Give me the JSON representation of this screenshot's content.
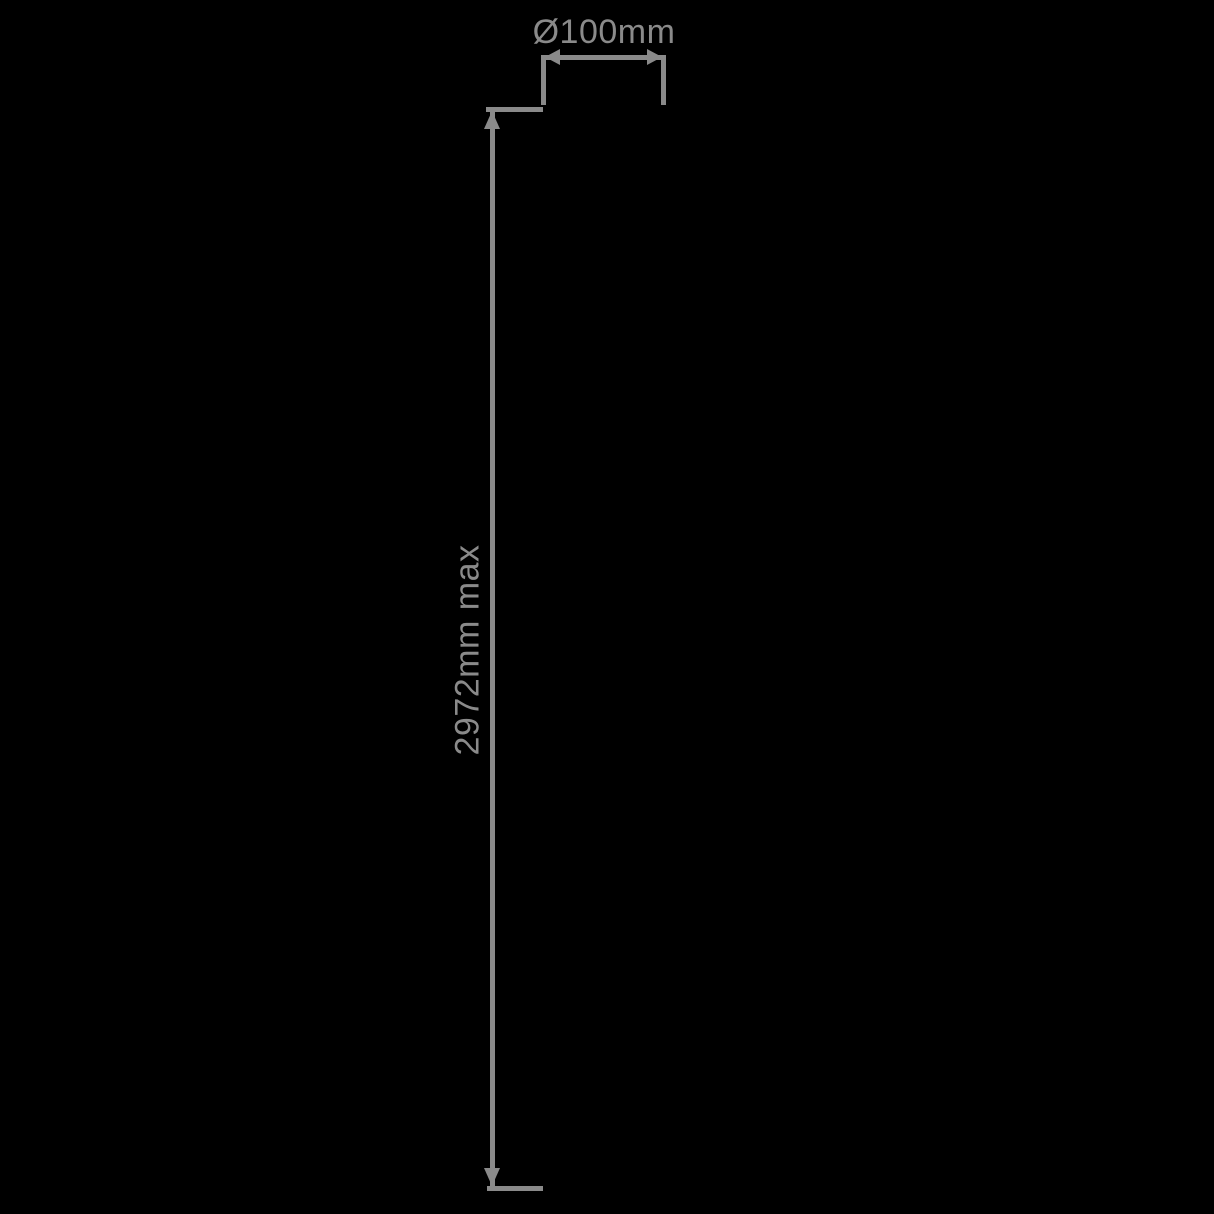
{
  "diagram": {
    "type": "technical-dimension-drawing",
    "background_color": "#000000",
    "line_color": "#8a8a8a",
    "diameter_dimension": {
      "label": "Ø100mm"
    },
    "height_dimension": {
      "label": "2972mm max",
      "orientation": "vertical",
      "label_rotation_deg": -90
    }
  }
}
